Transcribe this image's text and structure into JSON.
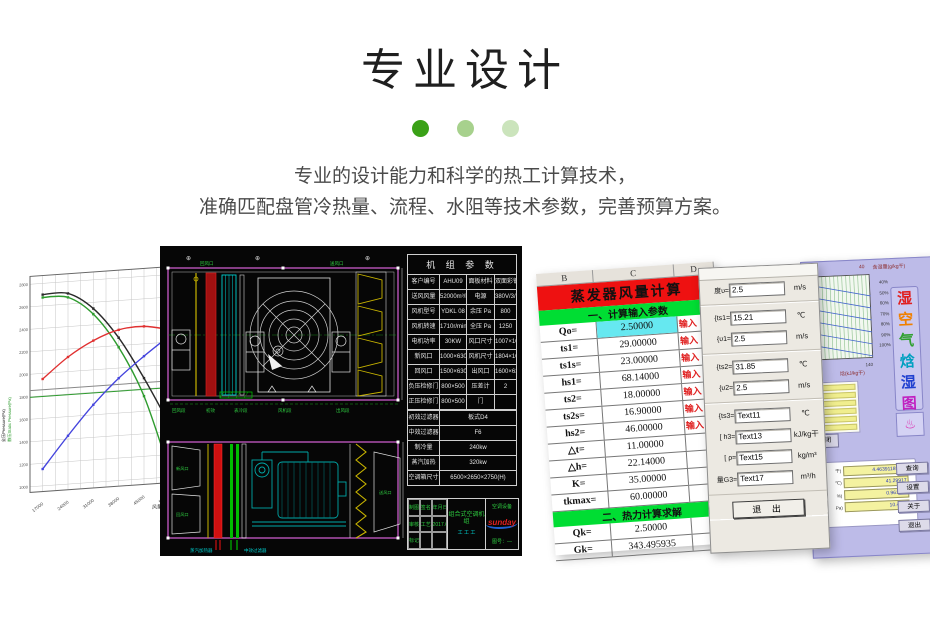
{
  "header": {
    "title": "专业设计",
    "dots": [
      "#3aa117",
      "#a7d18d",
      "#cbe4bc"
    ],
    "line1": "专业的设计能力和科学的热工计算技术，",
    "line2": "准确匹配盘管冷热量、流程、水阻等技术参数，完善预算方案。"
  },
  "chart_data": {
    "type": "line",
    "x": [
      17000,
      24000,
      31000,
      38000,
      45000,
      52000
    ],
    "xlabel": "风量(m³/h)",
    "ylabel_left_black": "全压Pressure(Pa)",
    "ylabel_left_green": "静压Static Pressure(Pa)",
    "xlim": [
      13500,
      55500
    ],
    "ylim": [
      950,
      2870
    ],
    "yticks": [
      1000,
      1200,
      1400,
      1600,
      1800,
      2000,
      2200,
      2400,
      2600,
      2800
    ],
    "grid": true,
    "series": [
      {
        "name": "全压曲线",
        "color": "#2a2a2a",
        "values": [
          2700,
          2695,
          2545,
          2270,
          1895,
          1470
        ]
      },
      {
        "name": "静压曲线",
        "color": "#2e9b2e",
        "values": [
          2675,
          2660,
          2495,
          2185,
          1735,
          1060
        ]
      },
      {
        "name": "红色曲线",
        "color": "#e03030",
        "values": [
          1950,
          2130,
          2260,
          2340,
          2355,
          2310
        ]
      },
      {
        "name": "蓝色曲线",
        "color": "#4444dd",
        "values": [
          1150,
          1430,
          1690,
          1910,
          2090,
          2255
        ]
      }
    ],
    "ref_lines": [
      {
        "axis": "x",
        "value": 50000,
        "color": "#ee55ee"
      },
      {
        "axis": "y",
        "value": 1855,
        "color": "#888888"
      },
      {
        "axis": "y",
        "value": 1795,
        "color": "#2e9b2e"
      }
    ]
  },
  "cad": {
    "top_labels": [
      "回风口",
      "送风口"
    ],
    "section_labels": [
      "回风段",
      "初效",
      "表冷段",
      "风机段",
      "出风段"
    ],
    "view2_labels": [
      "新风口",
      "回风口",
      "送风口"
    ],
    "bottom_labels": [
      "蒸汽加热器",
      "中效过滤器"
    ],
    "table": {
      "title": "机 组 参 数",
      "rows4": [
        {
          "a": "客户编号",
          "b": "AHU09",
          "c": "面板材料",
          "d": "双面彩钢板"
        },
        {
          "a": "送风风量",
          "b": "52000m³/h",
          "c": "电源",
          "d": "380V/3/50"
        },
        {
          "a": "风机型号",
          "b": "YDKL 08",
          "c": "余压 Pa",
          "d": "800"
        },
        {
          "a": "风机转速",
          "b": "1710r/min",
          "c": "全压 Pa",
          "d": "1250"
        },
        {
          "a": "电机功率",
          "b": "30KW",
          "c": "风口尺寸",
          "d": "1007×1007"
        },
        {
          "a": "新风口",
          "b": "1000×630",
          "c": "风机尺寸",
          "d": "1804×1097"
        },
        {
          "a": "回风口",
          "b": "1500×630",
          "c": "出风口",
          "d": "1600×630"
        },
        {
          "a": "负压检修门",
          "b": "800×500",
          "c": "压差计",
          "d": "2"
        },
        {
          "a": "正压检修门",
          "b": "800×500",
          "c": "门",
          "d": ""
        }
      ],
      "rows2": [
        {
          "a": "初效过滤器",
          "b": "板式D4"
        },
        {
          "a": "中效过滤器",
          "b": "F6"
        },
        {
          "a": "制冷量",
          "b": "240kw"
        },
        {
          "a": "蒸汽加热",
          "b": "320kw"
        },
        {
          "a": "空调箱尺寸",
          "b": "6500×2650×2750(H)"
        }
      ]
    },
    "titleblock": {
      "left_cells": [
        "制图",
        "签名",
        "年月日",
        "审核",
        "工艺",
        "2017.6.1",
        "标记",
        "",
        ""
      ],
      "product": "组合式空调机组",
      "marks": "工 工 工",
      "company": "空调设备",
      "brand": "sunday",
      "drawing_no": "图号：—"
    }
  },
  "sheet": {
    "cols": [
      "B",
      "C",
      "D"
    ],
    "title": "蒸发器风量计算",
    "banner1": "一、计算输入参数",
    "banner2": "二、热力计算求解",
    "input_rows": [
      {
        "label": "Qo=",
        "value": "2.50000",
        "note": "输入",
        "bg": "#66e8f0"
      },
      {
        "label": "ts1=",
        "value": "29.00000",
        "note": "输入"
      },
      {
        "label": "ts1s=",
        "value": "23.00000",
        "note": "输入"
      },
      {
        "label": "hs1=",
        "value": "68.14000",
        "note": "输入"
      },
      {
        "label": "ts2=",
        "value": "18.00000",
        "note": "输入"
      },
      {
        "label": "ts2s=",
        "value": "16.90000",
        "note": "输入"
      },
      {
        "label": "hs2=",
        "value": "46.00000",
        "note": "输入"
      },
      {
        "label": "△t=",
        "value": "11.00000",
        "note": ""
      },
      {
        "label": "△h=",
        "value": "22.14000",
        "note": ""
      },
      {
        "label": "K=",
        "value": "35.00000",
        "note": ""
      },
      {
        "label": "tkmax=",
        "value": "60.00000",
        "note": ""
      }
    ],
    "result_rows": [
      {
        "label": "Qk=",
        "value": "2.50000",
        "note": ""
      },
      {
        "label": "Gk=",
        "value": "343.495935",
        "note": ""
      }
    ]
  },
  "dialog": {
    "fields": [
      {
        "label": "度υ=",
        "value": "2.5",
        "unit": "m/s",
        "sepd": "none"
      },
      {
        "label": "{ts1=",
        "value": "15.21",
        "unit": "℃",
        "sepd": "block"
      },
      {
        "label": "{υ1=",
        "value": "2.5",
        "unit": "m/s",
        "sepd": "none"
      },
      {
        "label": "{ts2=",
        "value": "31.85",
        "unit": "℃",
        "sepd": "block"
      },
      {
        "label": "{υ2=",
        "value": "2.5",
        "unit": "m/s",
        "sepd": "none"
      },
      {
        "label": "{ts3=",
        "value": "Text11",
        "unit": "℃",
        "sepd": "block"
      },
      {
        "label": "[ h3=",
        "value": "Text13",
        "unit": "kJ/kg干",
        "sepd": "none"
      },
      {
        "label": "[ ρ=",
        "value": "Text15",
        "unit": "kg/m³",
        "sepd": "none"
      },
      {
        "label": "量G3=",
        "value": "Text17",
        "unit": "m³/h",
        "sepd": "none"
      }
    ],
    "exit_label": "退 出"
  },
  "psy": {
    "top_tick": "40",
    "top_axis_label": "含湿量(g/kg干)",
    "rh_ticks": [
      "40%",
      "50%",
      "60%",
      "70%",
      "80%",
      "90%",
      "100%"
    ],
    "bottom_tick": "140",
    "bottom_axis_label": "焓(kJ/kg干)",
    "app_title_chars": [
      {
        "ch": "湿",
        "color": "#e02020"
      },
      {
        "ch": "空",
        "color": "#f08000"
      },
      {
        "ch": "气",
        "color": "#30a030"
      },
      {
        "ch": "焓",
        "color": "#00a0c0"
      },
      {
        "ch": "湿",
        "color": "#2040d0"
      },
      {
        "ch": "图",
        "color": "#c020c0"
      }
    ],
    "logo_icon": "♨",
    "close_label": "关闭",
    "result_values": [
      {
        "label": "干)",
        "value": "4.4639118E-02"
      },
      {
        "label": "℃)",
        "value": "41.29917"
      },
      {
        "label": "%)",
        "value": "0.961925"
      },
      {
        "label": "Pa)",
        "value": "10.4672"
      }
    ],
    "buttons": [
      "查询",
      "设置",
      "关于",
      "退出"
    ]
  }
}
